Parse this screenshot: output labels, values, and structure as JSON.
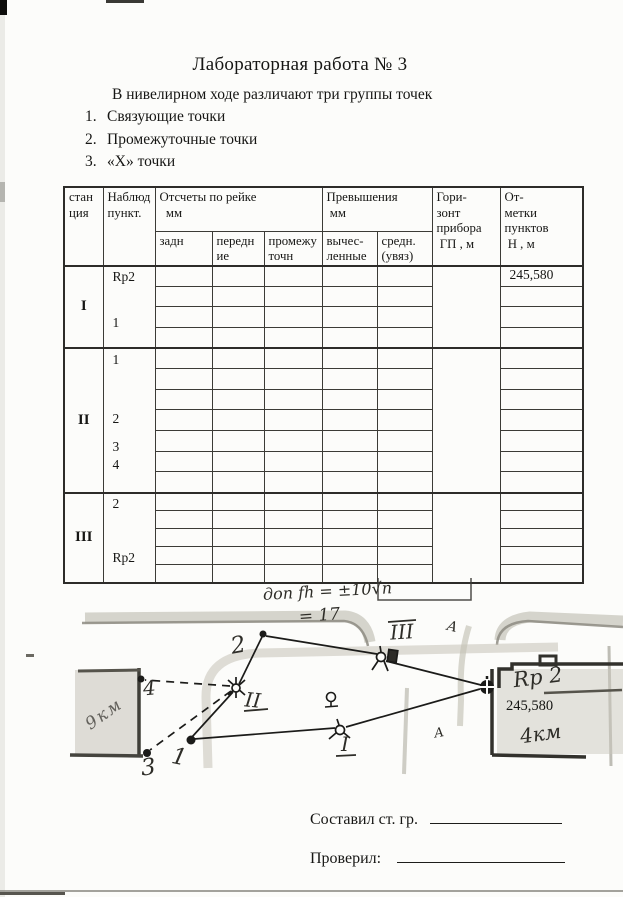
{
  "page": {
    "title": "Лабораторная работа № 3",
    "intro": "В нивелирном ходе различают три группы точек",
    "list": [
      {
        "num": "1.",
        "label": "Связующие точки"
      },
      {
        "num": "2.",
        "label": "Промежуточные точки"
      },
      {
        "num": "3.",
        "label": "«Х» точки"
      }
    ]
  },
  "table": {
    "headers": {
      "station": "стан\nция",
      "point": "Наблюд\nпункт.",
      "readings_group": "Отсчеты по рейке\n  мм",
      "back": "задн",
      "front": "передн\nие",
      "intermediate": "промежу\nточн",
      "elevations_group": "Превышения\n мм",
      "computed": "вычес-\nленные",
      "mean": "средн.\n(увяз)",
      "horizon": "Гори-\nзонт\nприбора\n ГП , м",
      "marks": "От-\nметки\nпунктов\n Н , м"
    },
    "stations": [
      {
        "name": "I",
        "rows": 4,
        "row_h": 20.5,
        "mark": "245,580",
        "points": [
          {
            "label": "Rp2",
            "top": 2
          },
          {
            "label": "1",
            "top": 48
          }
        ]
      },
      {
        "name": "II",
        "rows": 7,
        "row_h": 20.7,
        "mark": "",
        "points": [
          {
            "label": "1",
            "top": 3
          },
          {
            "label": "2",
            "top": 62
          },
          {
            "label": "3",
            "top": 90
          },
          {
            "label": "4",
            "top": 108
          }
        ]
      },
      {
        "name": "III",
        "rows": 5,
        "row_h": 18,
        "mark": "",
        "points": [
          {
            "label": "2",
            "top": 2
          },
          {
            "label": "Rp2",
            "top": 56
          }
        ]
      }
    ]
  },
  "formula": {
    "line1": "доп fh = ±10√n",
    "line2": "= 17"
  },
  "sketch": {
    "p1": "1",
    "p2": "2",
    "p3": "3",
    "p4": "4",
    "st1": "I",
    "st2": "II",
    "st3": "III",
    "rp2": "Rp 2",
    "rp2_elev": "245,580",
    "km_left": "9км",
    "km_right": "4км",
    "a1": "А",
    "a2": "А"
  },
  "footer": {
    "compiled": "Составил ст. гр.",
    "checked": "Проверил:"
  }
}
